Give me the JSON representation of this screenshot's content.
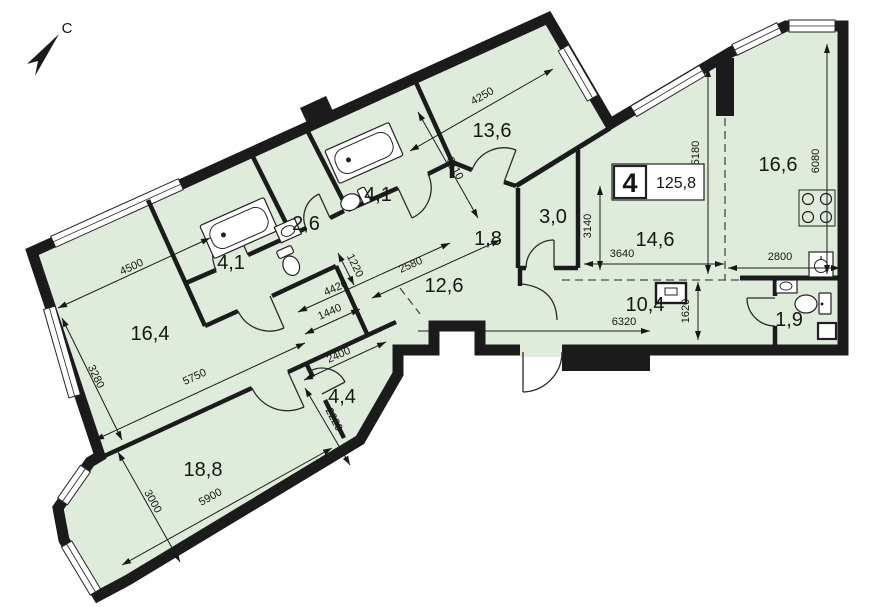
{
  "colors": {
    "background": "#ffffff",
    "floor": "#dfecdc",
    "walls": "#1b1b1b",
    "dimensions": "#161616"
  },
  "north": {
    "label": "С"
  },
  "unit_badge": {
    "room_count": "4",
    "total_area": "125,8"
  },
  "rooms": [
    {
      "area": "13,6"
    },
    {
      "area": "4,1"
    },
    {
      "area": "2,6"
    },
    {
      "area": "4,1"
    },
    {
      "area": "1,8"
    },
    {
      "area": "3,0"
    },
    {
      "area": "16,6"
    },
    {
      "area": "14,6"
    },
    {
      "area": "10,4"
    },
    {
      "area": "1,9"
    },
    {
      "area": "12,6"
    },
    {
      "area": "16,4"
    },
    {
      "area": "4,4"
    },
    {
      "area": "18,8"
    }
  ],
  "dimensions": [
    {
      "value": "4250"
    },
    {
      "value": "3110"
    },
    {
      "value": "4500"
    },
    {
      "value": "3280"
    },
    {
      "value": "5750"
    },
    {
      "value": "3000"
    },
    {
      "value": "5900"
    },
    {
      "value": "2400"
    },
    {
      "value": "2220"
    },
    {
      "value": "1440"
    },
    {
      "value": "4420"
    },
    {
      "value": "1220"
    },
    {
      "value": "2580"
    },
    {
      "value": "3140"
    },
    {
      "value": "3640"
    },
    {
      "value": "5180"
    },
    {
      "value": "6080"
    },
    {
      "value": "2800"
    },
    {
      "value": "6320"
    },
    {
      "value": "1620"
    }
  ]
}
